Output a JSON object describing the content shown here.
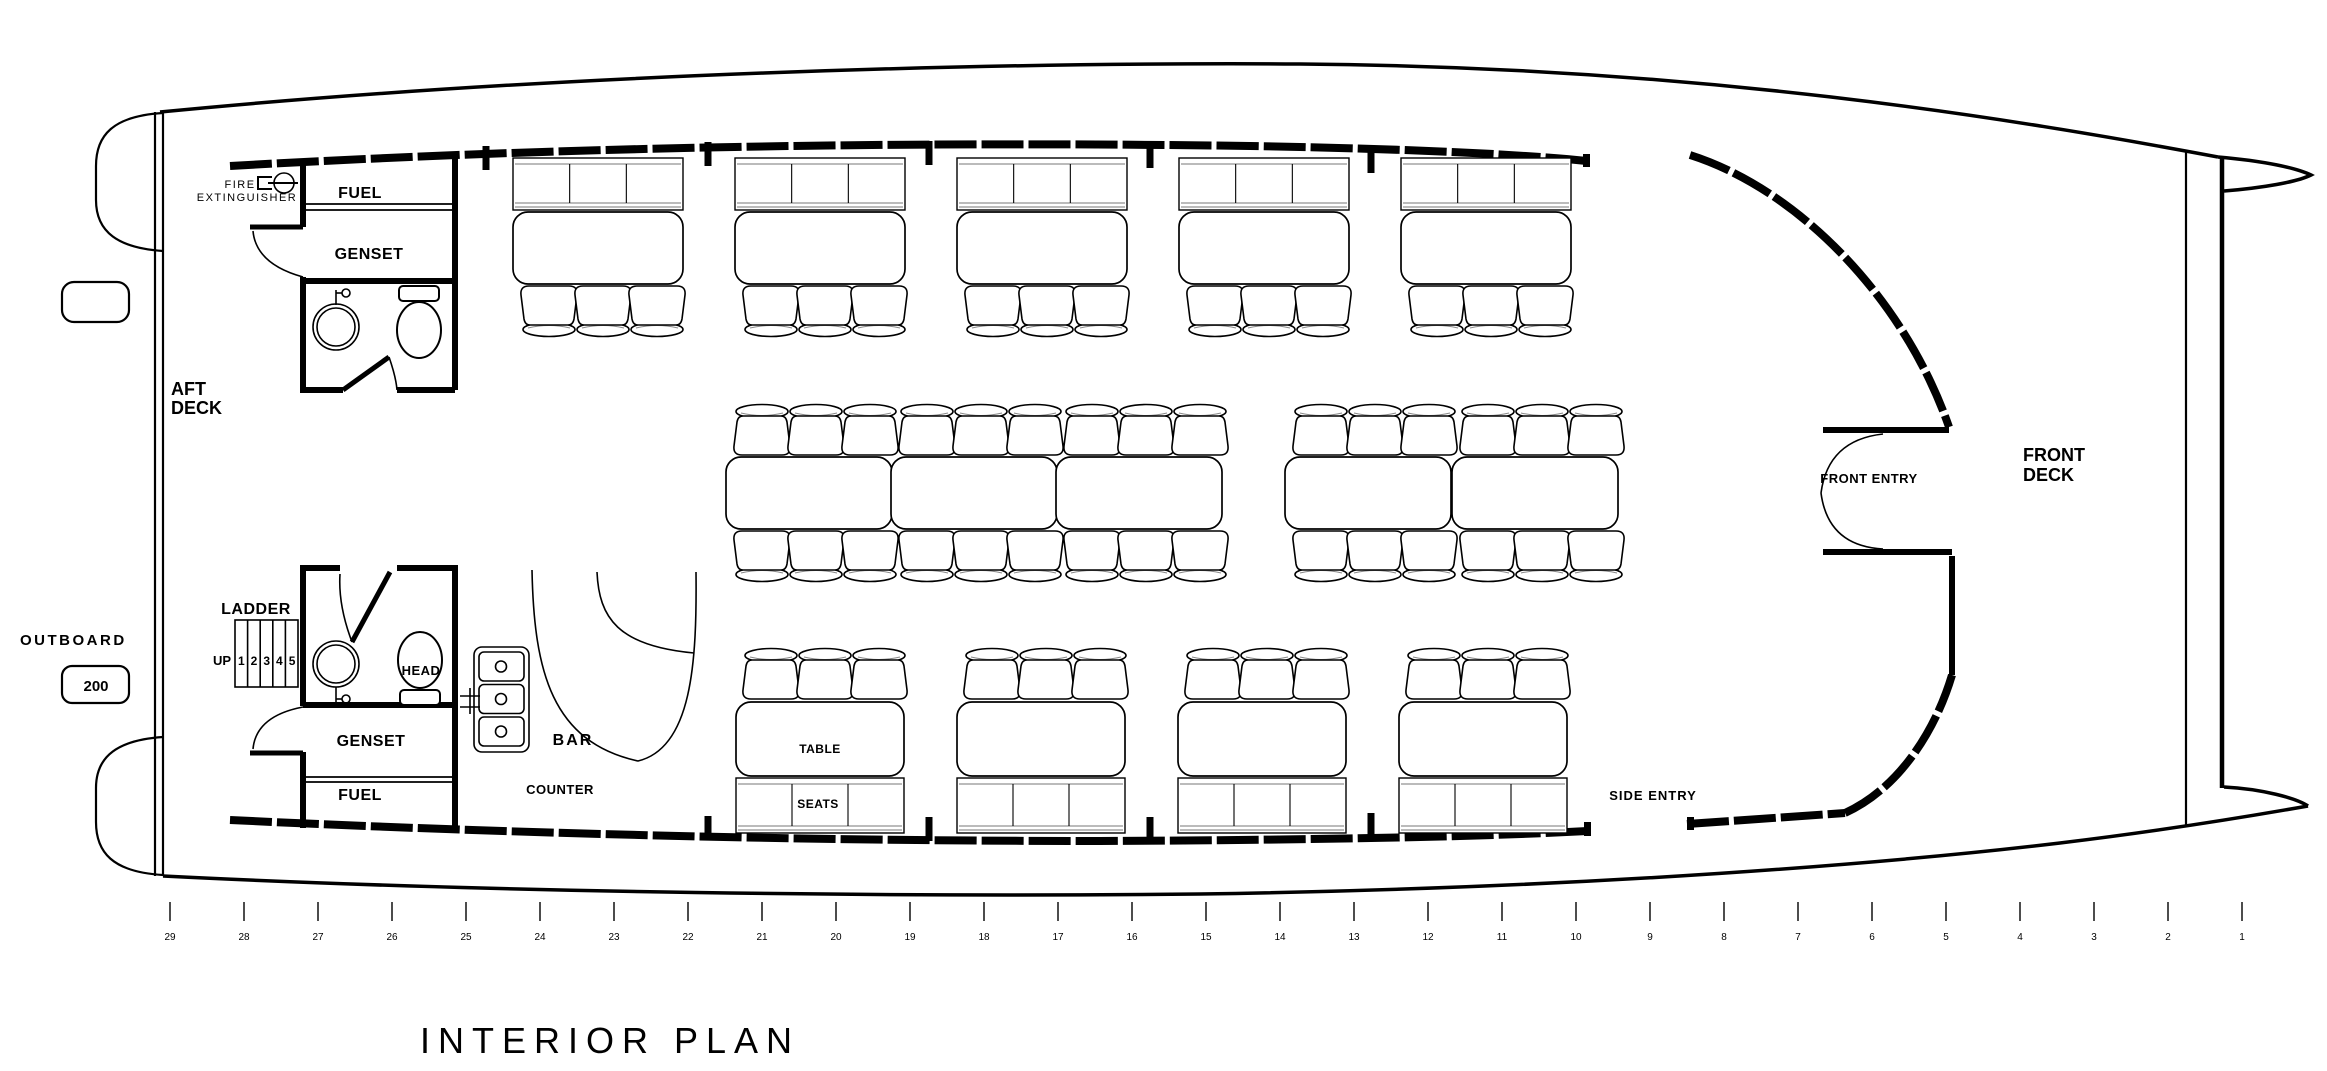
{
  "title": "INTERIOR PLAN",
  "labels": {
    "fire_line1": "FIRE",
    "fire_line2": "EXTINGUISHER",
    "fuel_top": "FUEL",
    "genset_top": "GENSET",
    "aft_deck_line1": "AFT",
    "aft_deck_line2": "DECK",
    "outboard": "OUTBOARD",
    "outboard_power": "200",
    "ladder": "LADDER",
    "ladder_up": "UP",
    "head": "HEAD",
    "genset_bottom": "GENSET",
    "fuel_bottom": "FUEL",
    "bar": "BAR",
    "counter": "COUNTER",
    "table": "TABLE",
    "seats": "SEATS",
    "front_entry": "FRONT ENTRY",
    "front_deck_line1": "FRONT",
    "front_deck_line2": "DECK",
    "side_entry": "SIDE ENTRY"
  },
  "ladder_steps": [
    "1",
    "2",
    "3",
    "4",
    "5"
  ],
  "ruler": {
    "stations": [
      29,
      28,
      27,
      26,
      25,
      24,
      23,
      22,
      21,
      20,
      19,
      18,
      17,
      16,
      15,
      14,
      13,
      12,
      11,
      10,
      9,
      8,
      7,
      6,
      5,
      4,
      3,
      2,
      1
    ],
    "x0": 170,
    "dx": 74,
    "tick_y1": 902,
    "tick_y2": 921,
    "label_y": 940
  },
  "plan": {
    "top_booths_x": [
      513,
      735,
      957,
      1179,
      1401
    ],
    "mid_tables_x": [
      726,
      891,
      1056,
      1285,
      1452
    ],
    "bottom_booths_x": [
      736,
      957,
      1178,
      1399
    ],
    "posts_top": [
      [
        486,
        146
      ],
      [
        708,
        142
      ],
      [
        929,
        141
      ],
      [
        1150,
        144
      ],
      [
        1371,
        149
      ]
    ],
    "posts_bottom": [
      [
        708,
        816
      ],
      [
        929,
        817
      ],
      [
        1150,
        817
      ],
      [
        1371,
        813
      ]
    ]
  },
  "colors": {
    "ink": "#000000",
    "paper": "#ffffff"
  }
}
